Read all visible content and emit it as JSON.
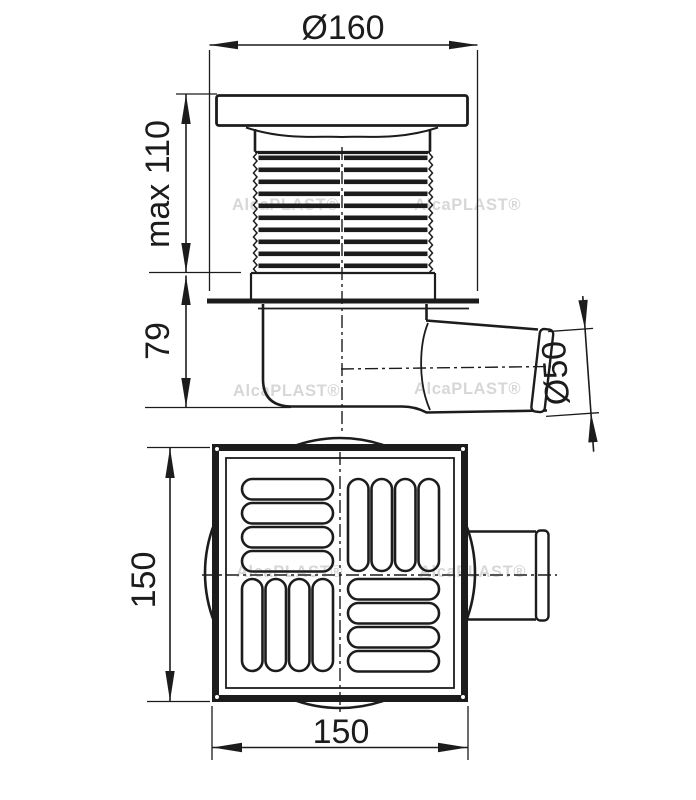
{
  "drawing": {
    "type": "technical drawing, floor drain, side view and plan view",
    "dimensions": {
      "flange_diameter": "Ø160",
      "max_height": "max 110",
      "body_height": "79",
      "outlet_diameter": "Ø50",
      "plan_height": "150",
      "plan_width": "150"
    },
    "watermark": "AlcaPLAST®",
    "colors": {
      "line": "#1c1c1c",
      "watermark": "#d7d7d7",
      "background": "#ffffff"
    }
  }
}
